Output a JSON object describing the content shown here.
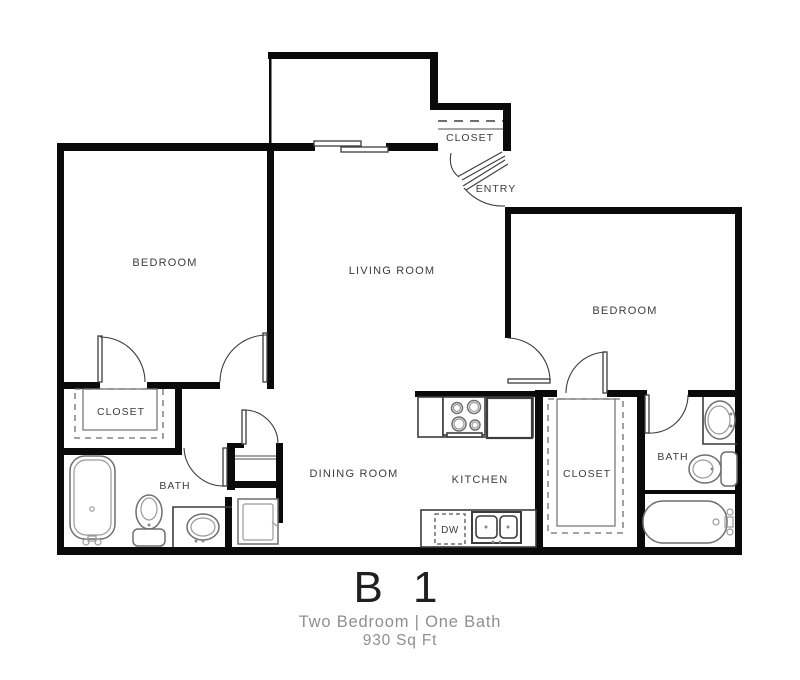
{
  "plan": {
    "title": "B 1",
    "subtitle": "Two Bedroom  |  One Bath",
    "area": "930 Sq Ft"
  },
  "labels": {
    "bedroom_left": "BEDROOM",
    "living_room": "LIVING ROOM",
    "bedroom_right": "BEDROOM",
    "closet_entry": "CLOSET",
    "entry": "ENTRY",
    "closet_left": "CLOSET",
    "closet_right": "CLOSET",
    "bath_left": "BATH",
    "bath_right": "BATH",
    "dining_room": "DINING ROOM",
    "kitchen": "KITCHEN",
    "dishwasher": "DW"
  },
  "colors": {
    "wall": "#0a0a0a",
    "line": "#3c3c3c",
    "fixture": "#6e6e6e",
    "label": "#3d3d3d",
    "title": "#1f1f1f",
    "subtitle_text": "#8f8f8f",
    "background": "#ffffff"
  }
}
